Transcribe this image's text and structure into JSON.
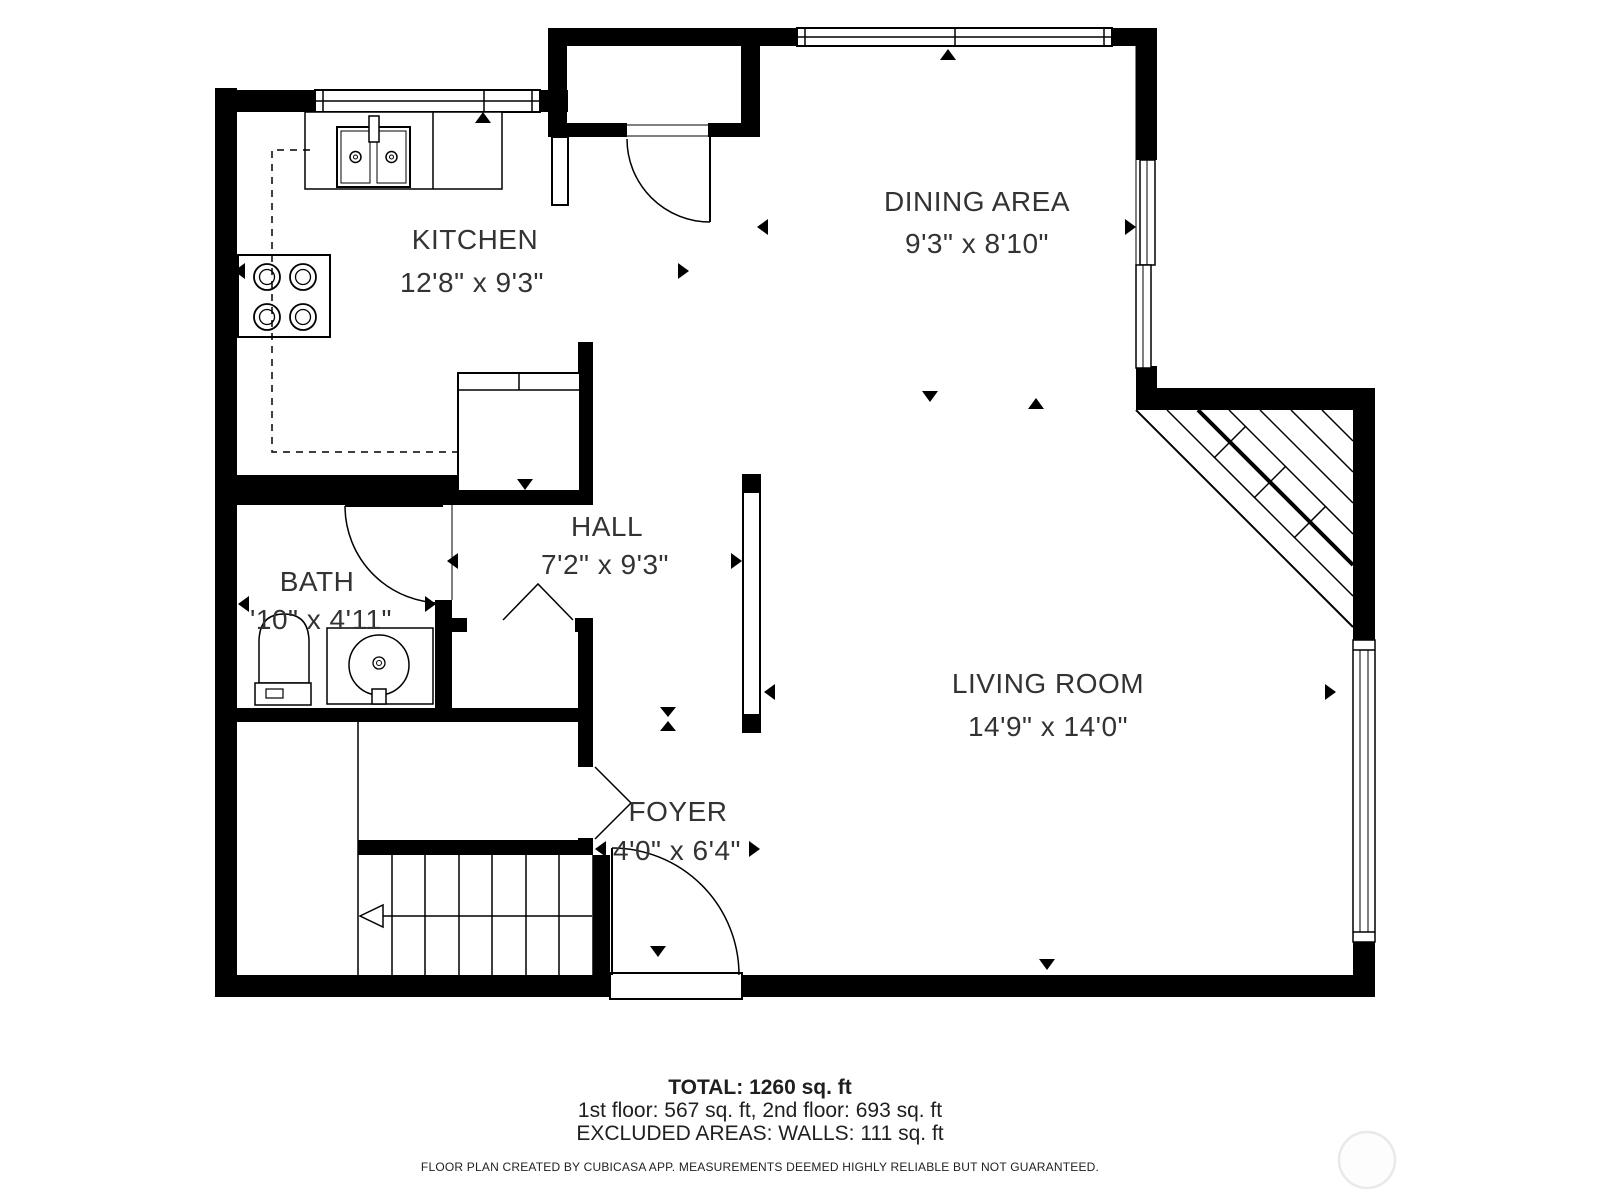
{
  "title": "First floor plan",
  "colors": {
    "wall": "#000000",
    "text": "#333333",
    "background": "#ffffff",
    "watermark": "#e9e9e9"
  },
  "rooms": {
    "kitchen": {
      "name": "KITCHEN",
      "dims": "12'8\" x 9'3\""
    },
    "dining": {
      "name": "DINING AREA",
      "dims": "9'3\" x 8'10\""
    },
    "hall": {
      "name": "HALL",
      "dims": "7'2\" x 9'3\""
    },
    "bath": {
      "name": "BATH",
      "dims": "'10\" x 4'11\""
    },
    "living": {
      "name": "LIVING ROOM",
      "dims": "14'9\" x 14'0\""
    },
    "foyer": {
      "name": "FOYER",
      "dims": "4'0\" x 6'4\""
    }
  },
  "footer": {
    "total": "TOTAL: 1260 sq. ft",
    "floors": "1st floor: 567 sq. ft, 2nd floor: 693 sq. ft",
    "excluded": "EXCLUDED AREAS: WALLS: 111 sq. ft",
    "disclaimer": "FLOOR PLAN CREATED BY CUBICASA APP. MEASUREMENTS DEEMED HIGHLY RELIABLE BUT NOT GUARANTEED."
  },
  "icons": {
    "stove-icon": "4-burner cooktop (four double circles)",
    "kitchen-sink-icon": "double-basin sink with faucet",
    "refrigerator-icon": "counter-depth appliance rectangle",
    "toilet-icon": "toilet with tank and flush button",
    "bath-sink-icon": "round basin in square vanity",
    "stairs-icon": "staircase, up-direction arrow pointing left",
    "door-swing-icon": "quarter-circle door swing arc",
    "bifold-door-icon": "V-shaped folding closet door",
    "window-icon": "double-line window in wall",
    "dimension-arrow-icon": "small solid triangle marker",
    "watermark-circle": "faint circular logo"
  }
}
